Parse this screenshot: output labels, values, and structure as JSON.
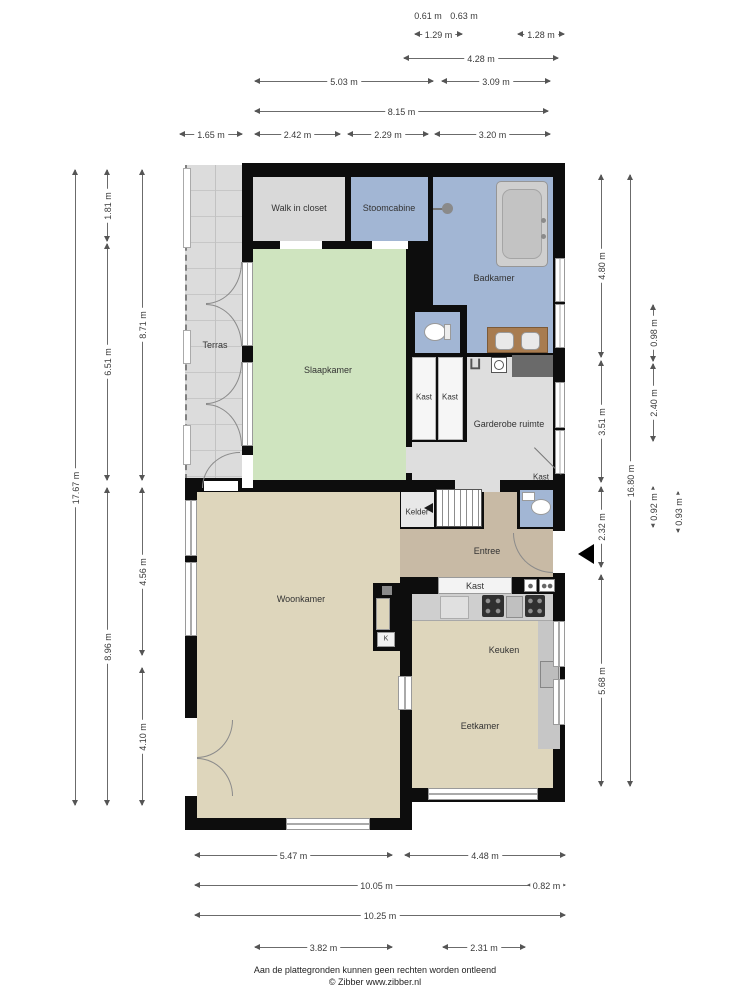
{
  "rooms": {
    "terras": "Terras",
    "walk_in_closet": "Walk in closet",
    "stoomcabine": "Stoomcabine",
    "badkamer": "Badkamer",
    "slaapkamer": "Slaapkamer",
    "kast_1": "Kast",
    "kast_2": "Kast",
    "garderobe": "Garderobe ruimte",
    "kast_3": "Kast",
    "kelder": "Kelder",
    "entree": "Entree",
    "kast_4": "Kast",
    "woonkamer": "Woonkamer",
    "kast_k": "K",
    "keuken": "Keuken",
    "eetkamer": "Eetkamer"
  },
  "dimensions": [
    {
      "text": "0.61 m",
      "dir": "h",
      "x": 428,
      "y": 16,
      "len": 0
    },
    {
      "text": "0.63 m",
      "dir": "h",
      "x": 464,
      "y": 16,
      "len": 0
    },
    {
      "text": "1.29 m",
      "dir": "h",
      "x": 415,
      "y": 34,
      "len": 47
    },
    {
      "text": "1.28 m",
      "dir": "h",
      "x": 518,
      "y": 34,
      "len": 46
    },
    {
      "text": "4.28 m",
      "dir": "h",
      "x": 404,
      "y": 58,
      "len": 154
    },
    {
      "text": "5.03 m",
      "dir": "h",
      "x": 255,
      "y": 81,
      "len": 178
    },
    {
      "text": "3.09 m",
      "dir": "h",
      "x": 442,
      "y": 81,
      "len": 108
    },
    {
      "text": "8.15 m",
      "dir": "h",
      "x": 255,
      "y": 111,
      "len": 293
    },
    {
      "text": "1.65 m",
      "dir": "h",
      "x": 180,
      "y": 134,
      "len": 62
    },
    {
      "text": "2.42 m",
      "dir": "h",
      "x": 255,
      "y": 134,
      "len": 85
    },
    {
      "text": "2.29 m",
      "dir": "h",
      "x": 348,
      "y": 134,
      "len": 80
    },
    {
      "text": "3.20 m",
      "dir": "h",
      "x": 435,
      "y": 134,
      "len": 115
    },
    {
      "text": "17.67 m",
      "dir": "v",
      "x": 75,
      "y": 170,
      "len": 635
    },
    {
      "text": "1.81 m",
      "dir": "v",
      "x": 107,
      "y": 170,
      "len": 71
    },
    {
      "text": "6.51 m",
      "dir": "v",
      "x": 107,
      "y": 244,
      "len": 236
    },
    {
      "text": "8.96 m",
      "dir": "v",
      "x": 107,
      "y": 488,
      "len": 317
    },
    {
      "text": "8.71 m",
      "dir": "v",
      "x": 142,
      "y": 170,
      "len": 310
    },
    {
      "text": "4.56 m",
      "dir": "v",
      "x": 142,
      "y": 488,
      "len": 167
    },
    {
      "text": "4.10 m",
      "dir": "v",
      "x": 142,
      "y": 668,
      "len": 137
    },
    {
      "text": "4.80 m",
      "dir": "v",
      "x": 601,
      "y": 175,
      "len": 182
    },
    {
      "text": "3.51 m",
      "dir": "v",
      "x": 601,
      "y": 361,
      "len": 121
    },
    {
      "text": "2.32 m",
      "dir": "v",
      "x": 601,
      "y": 487,
      "len": 80
    },
    {
      "text": "5.68 m",
      "dir": "v",
      "x": 601,
      "y": 575,
      "len": 211
    },
    {
      "text": "16.80 m",
      "dir": "v",
      "x": 630,
      "y": 175,
      "len": 611
    },
    {
      "text": "0.98 m",
      "dir": "v",
      "x": 653,
      "y": 305,
      "len": 56
    },
    {
      "text": "2.40 m",
      "dir": "v",
      "x": 653,
      "y": 364,
      "len": 77
    },
    {
      "text": "0.92 m",
      "dir": "v",
      "x": 653,
      "y": 487,
      "len": 40
    },
    {
      "text": "0.93 m",
      "dir": "v",
      "x": 678,
      "y": 492,
      "len": 40
    },
    {
      "text": "5.47 m",
      "dir": "h",
      "x": 195,
      "y": 855,
      "len": 197
    },
    {
      "text": "4.48 m",
      "dir": "h",
      "x": 405,
      "y": 855,
      "len": 160
    },
    {
      "text": "10.05 m",
      "dir": "h",
      "x": 195,
      "y": 885,
      "len": 363
    },
    {
      "text": "0.82 m",
      "dir": "h",
      "x": 528,
      "y": 885,
      "len": 37
    },
    {
      "text": "10.25 m",
      "dir": "h",
      "x": 195,
      "y": 915,
      "len": 370
    },
    {
      "text": "3.82 m",
      "dir": "h",
      "x": 255,
      "y": 947,
      "len": 137
    },
    {
      "text": "2.31 m",
      "dir": "h",
      "x": 443,
      "y": 947,
      "len": 82
    }
  ],
  "footer": {
    "line1": "Aan de plattegronden kunnen geen rechten worden ontleend",
    "line2": "© Zibber www.zibber.nl"
  },
  "colors": {
    "wall": "#0d0d0d",
    "bedroom_green": "#cfe4bf",
    "bath_blue": "#a2b6d4",
    "gray_room": "#d9d9d9",
    "terrace_gray": "#dcdcdc",
    "living_beige": "#ded6bc",
    "entry_tan": "#c8baa5",
    "counter_gray": "#cfcfcf",
    "vanity_brown": "#a87c50",
    "dim_line": "#555555"
  },
  "icons": [
    "bathtub-icon",
    "shower-head-icon",
    "toilet-icon",
    "sink-icon",
    "washing-machine-icon",
    "laundry-basket-icon",
    "stove-icon",
    "kitchen-sink-icon",
    "fridge-icon",
    "stairs-icon",
    "door-arc-icon",
    "window-icon",
    "entrance-arrow-icon",
    "kelder-arrow-icon"
  ]
}
